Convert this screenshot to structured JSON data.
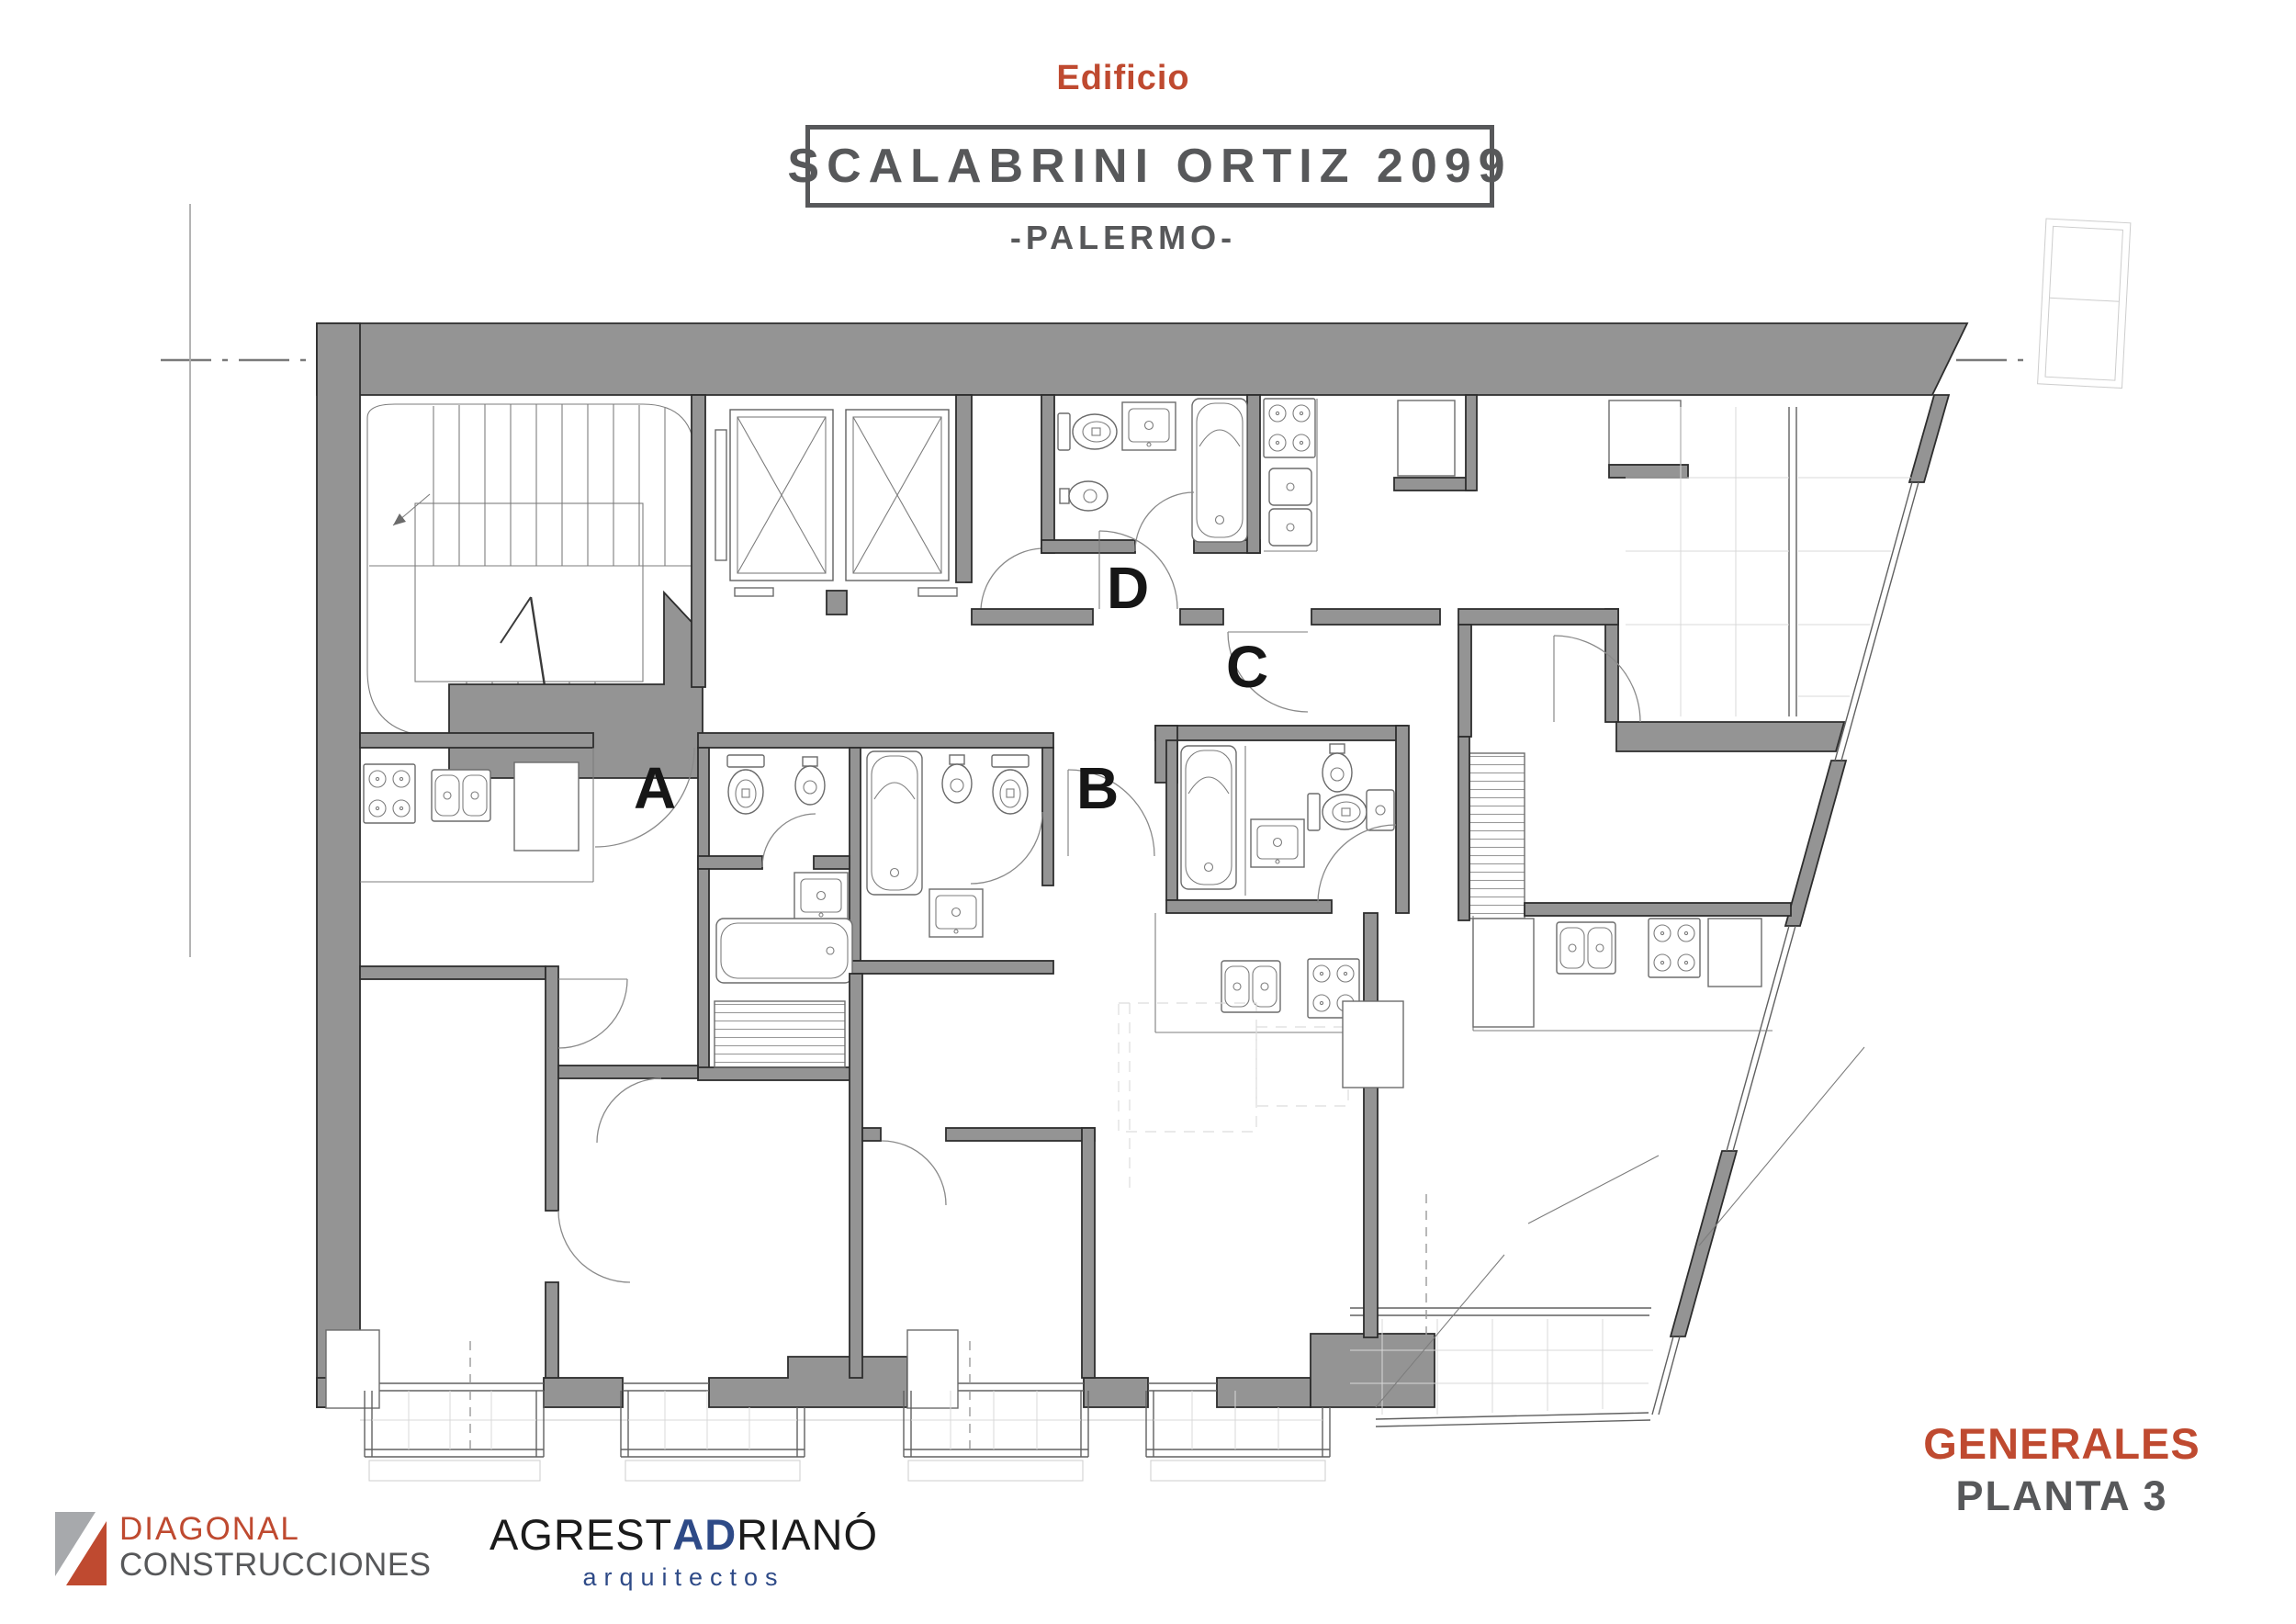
{
  "header": {
    "eyebrow": "Edificio",
    "title": "SCALABRINI ORTIZ 2099",
    "subtitle": "-PALERMO-"
  },
  "plan": {
    "unit_a": "A",
    "unit_b": "B",
    "unit_c": "C",
    "unit_d": "D"
  },
  "sheet": {
    "category": "GENERALES",
    "name": "PLANTA 3"
  },
  "brands": {
    "diagonal": {
      "name": "DIAGONAL",
      "subname": "CONSTRUCCIONES"
    },
    "agrest": {
      "part1": "AGREST",
      "part2": "AD",
      "part3": "RIANÓ",
      "tagline": "arquitectos"
    }
  },
  "colors": {
    "accent_red": "#bf4a30",
    "dark_gray": "#57585a",
    "wall_gray": "#949494",
    "brand_blue": "#2e4a87"
  }
}
